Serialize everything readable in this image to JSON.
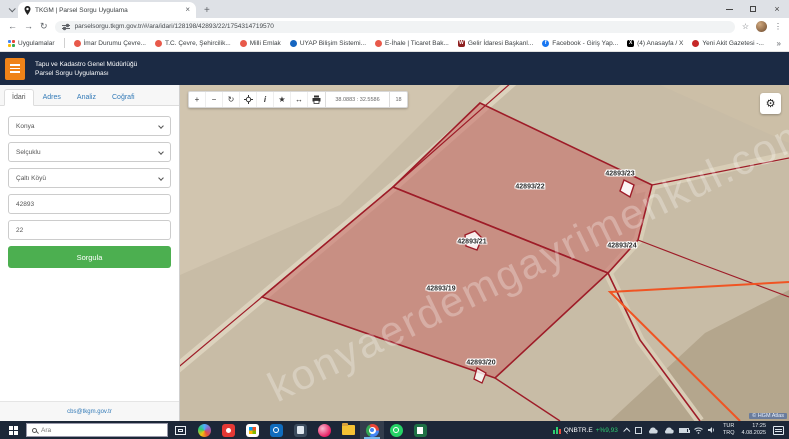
{
  "browser": {
    "tab_title": "TKGM | Parsel Sorgu Uygulama",
    "url": "parselsorgu.tkgm.gov.tr/#/ara/idari/128198/42893/22/1754314719570"
  },
  "glyphs": {
    "back": "←",
    "forward": "→",
    "reload": "↻",
    "star": "☆",
    "menu": "⋮",
    "plus": "+",
    "close": "×",
    "overflow": "»",
    "zoom_in": "+",
    "zoom_out": "−",
    "refresh": "↻",
    "info": "i",
    "favorite": "★",
    "measure": "↔",
    "settings": "⚙"
  },
  "bookmarks": {
    "apps_label": "Uygulamalar",
    "items": [
      {
        "label": "İmar Durumu Çevre...",
        "color": "#e8594a",
        "letter": ""
      },
      {
        "label": "T.C. Çevre, Şehircilik...",
        "color": "#e8594a",
        "letter": ""
      },
      {
        "label": "Milli Emlak",
        "color": "#e8594a",
        "letter": ""
      },
      {
        "label": "UYAP Bilişim Sistemi...",
        "color": "#1565c0",
        "letter": ""
      },
      {
        "label": "E-İhale | Ticaret Bak...",
        "color": "#e8594a",
        "letter": ""
      },
      {
        "label": "Gelir İdaresi Başkanl...",
        "color": "#8e1f1f",
        "letter": "W"
      },
      {
        "label": "Facebook - Giriş Yap...",
        "color": "#1877f2",
        "letter": "f"
      },
      {
        "label": "(4) Anasayfa / X",
        "color": "#000000",
        "letter": "X"
      },
      {
        "label": "Yeni Akit Gazetesi -...",
        "color": "#c62828",
        "letter": ""
      }
    ]
  },
  "header": {
    "title_line1": "Tapu ve Kadastro Genel Müdürlüğü",
    "title_line2": "Parsel Sorgu Uygulaması"
  },
  "sidebar": {
    "tabs": [
      {
        "label": "İdari"
      },
      {
        "label": "Adres"
      },
      {
        "label": "Analiz"
      },
      {
        "label": "Coğrafi"
      }
    ],
    "province": "Konya",
    "district": "Selçuklu",
    "neighborhood": "Çaltı Köyü",
    "block_no": "42893",
    "parcel_no": "22",
    "query_button": "Sorgula",
    "footer_link": "cbs@tkgm.gov.tr"
  },
  "map": {
    "coordinates": "38.0883 : 32.5586",
    "zoom_level": "18",
    "parcels": [
      {
        "label": "42893/22"
      },
      {
        "label": "42893/23"
      },
      {
        "label": "42893/21"
      },
      {
        "label": "42893/24"
      },
      {
        "label": "42893/19"
      },
      {
        "label": "42893/20"
      }
    ],
    "watermark": "konyaerdemgayrimenkul.com",
    "attribution": "© HGM Atlas",
    "colors": {
      "parcel_fill": "#c96a66",
      "parcel_stroke": "#9e1c28",
      "highlight_line": "#f05423"
    }
  },
  "taskbar": {
    "search_placeholder": "Ara",
    "ticker": {
      "symbol": "QNBTR.E",
      "change": "+%9,93"
    },
    "language": {
      "line1": "TUR",
      "line2": "TRQ"
    },
    "clock": {
      "time": "17:25",
      "date": "4.08.2025"
    }
  }
}
